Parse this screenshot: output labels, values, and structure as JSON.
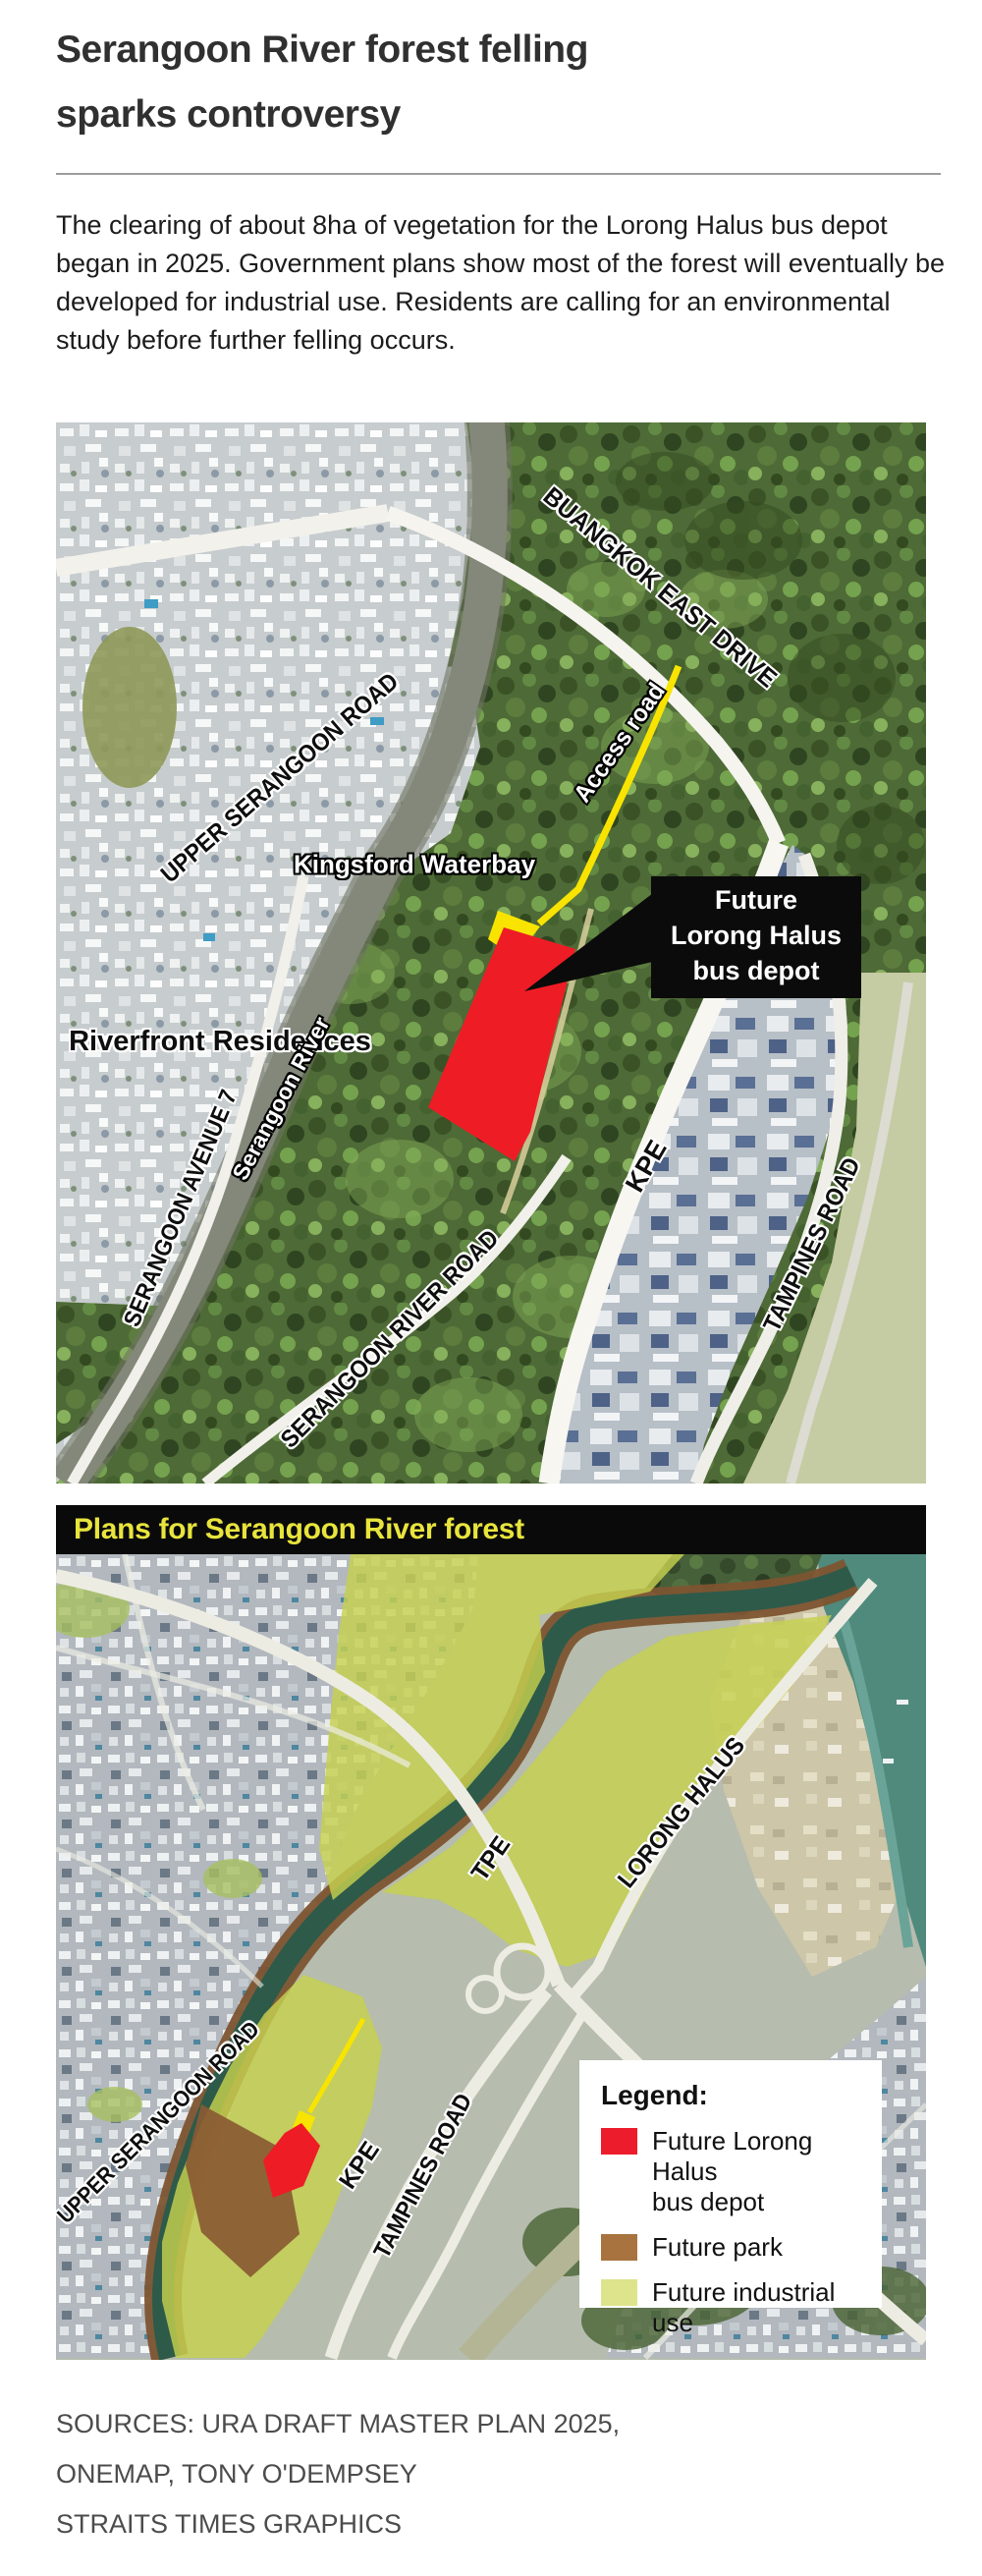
{
  "article": {
    "headline": "Serangoon River forest felling\nsparks controversy",
    "intro": "The clearing of about 8ha of vegetation for the Lorong Halus bus depot began in 2025. Government plans show most of the forest will eventually be developed for industrial use. Residents are calling for an environmental study before further felling occurs."
  },
  "map1": {
    "labels": {
      "buangkok_east_drive": "BUANGKOK EAST DRIVE",
      "access_road": "Access road",
      "upper_serangoon_road": "UPPER SERANGOON ROAD",
      "kingsford_waterbay": "Kingsford\nWaterbay",
      "riverfront_residences": "Riverfront\nResidences",
      "serangoon_river": "Serangoon River",
      "serangoon_avenue_7": "SERANGOON AVENUE 7",
      "serangoon_river_road": "SERANGOON  RIVER  ROAD",
      "kpe": "KPE",
      "tampines_road": "TAMPINES ROAD"
    },
    "callout": "Future\nLorong Halus\nbus depot"
  },
  "map2": {
    "title": "Plans for Serangoon River forest",
    "labels": {
      "tpe": "TPE",
      "lorong_halus": "LORONG HALUS",
      "upper_serangoon_road": "UPPER SERANGOON ROAD",
      "kpe": "KPE",
      "tampines_road": "TAMPINES ROAD"
    },
    "legend": {
      "title": "Legend:",
      "items": [
        {
          "color": "#ed1c2c",
          "label": "Future Lorong Halus\nbus depot"
        },
        {
          "color": "#a8733f",
          "label": "Future park"
        },
        {
          "color": "#dde48b",
          "label": "Future industrial use"
        }
      ]
    }
  },
  "footer": {
    "lines": [
      "SOURCES: URA DRAFT MASTER PLAN 2025,",
      "ONEMAP, TONY O'DEMPSEY",
      "STRAITS TIMES GRAPHICS"
    ]
  },
  "colors": {
    "depot_red": "#ee1c25",
    "park_brown": "#8a5a33",
    "industrial_overlay": "#c6d14f",
    "access_road_yellow": "#f8e400",
    "map2_title_yellow": "#e8e43c"
  }
}
